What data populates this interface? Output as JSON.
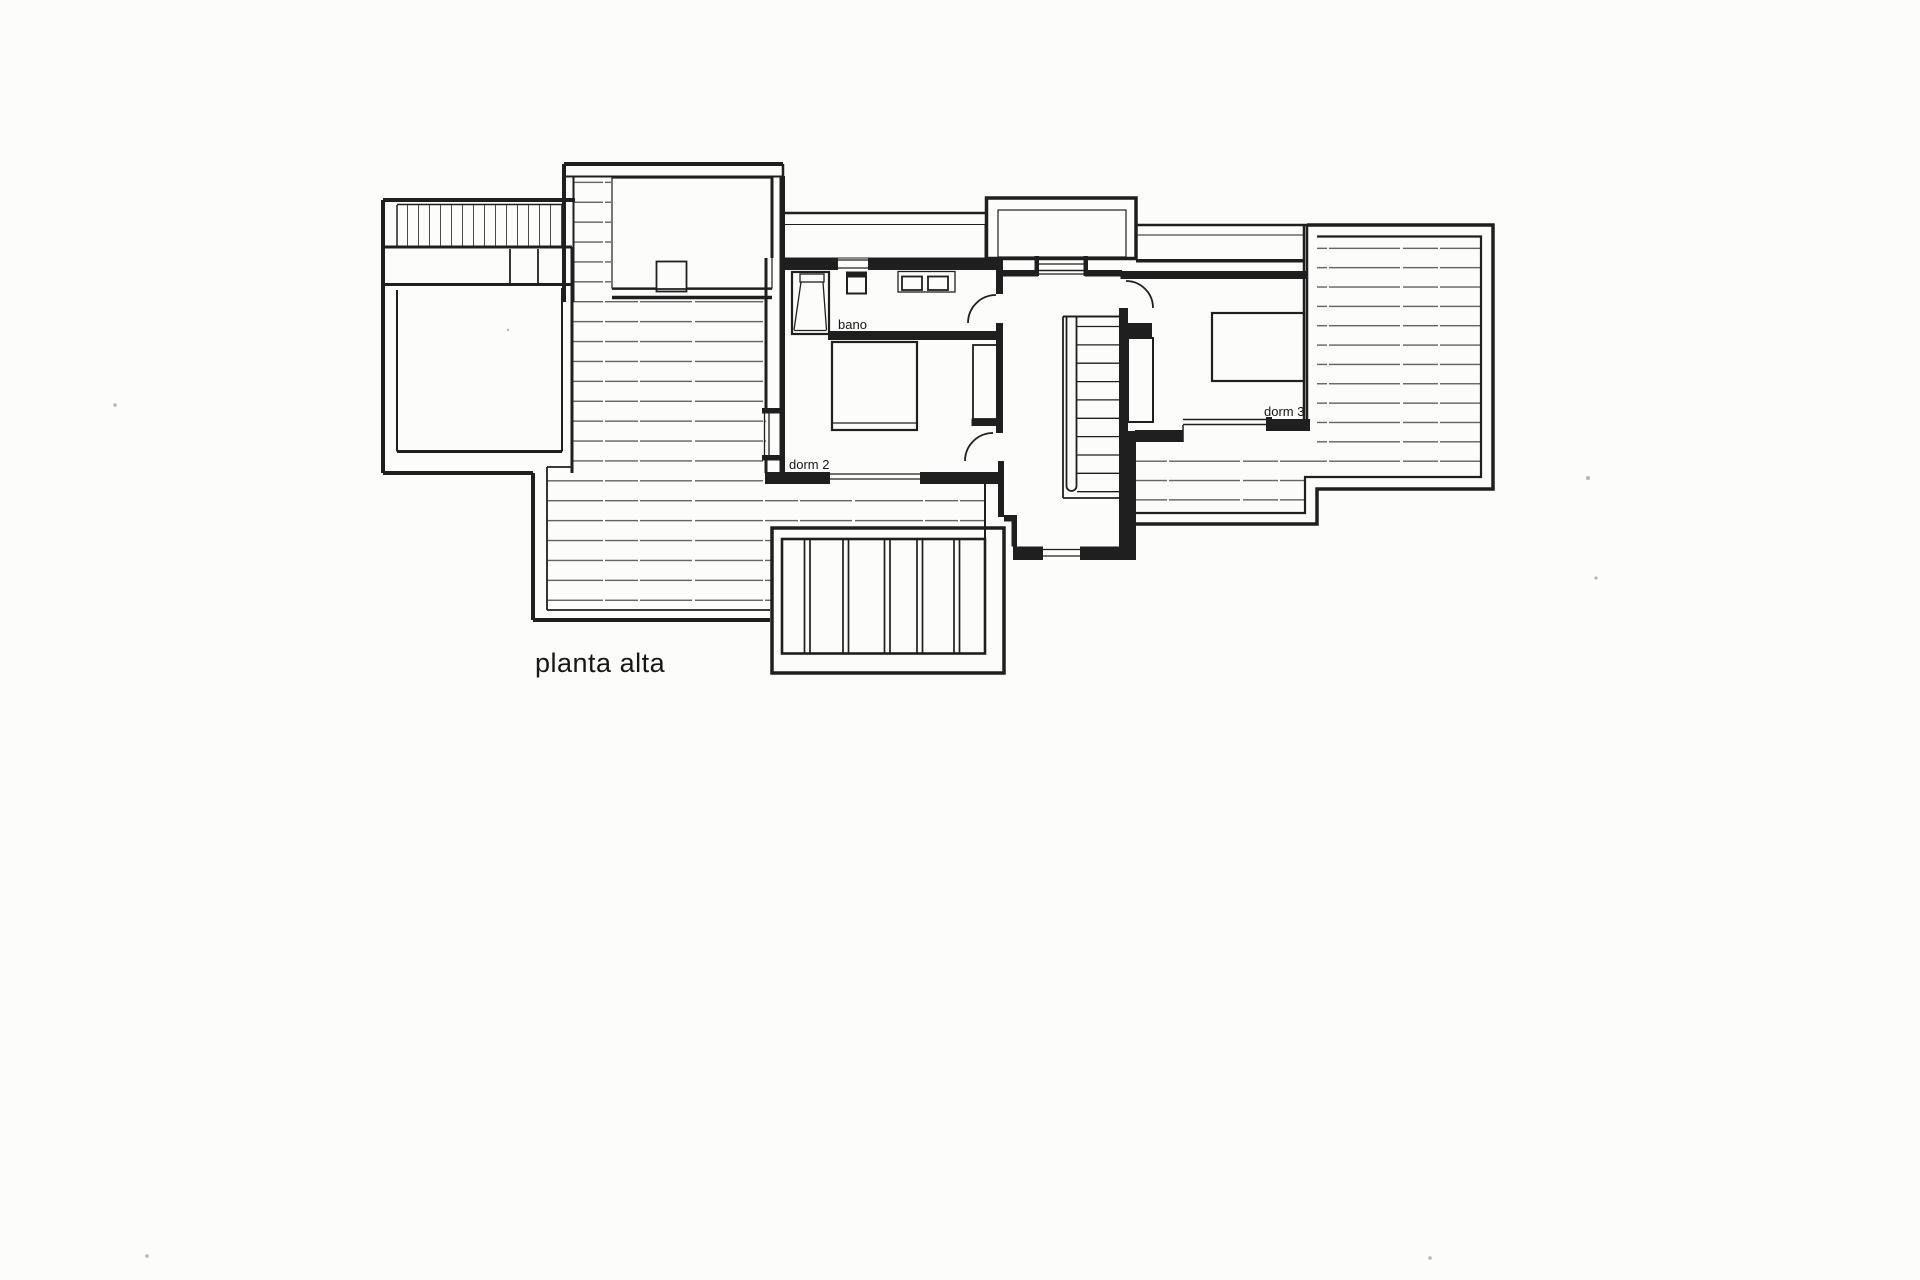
{
  "document": {
    "type": "scanned architectural floor plan",
    "caption": "planta alta"
  },
  "labels": {
    "bathroom": "bano",
    "bedroom2": "dorm 2",
    "bedroom3": "dorm 3",
    "caption": "planta alta"
  },
  "colors": {
    "paper": "#fcfcfa",
    "ink": "#1f1f1f",
    "deck_line": "#4f4f4f",
    "stipple_dot": "#454545"
  },
  "rooms": [
    {
      "name": "bano",
      "kind": "bathroom"
    },
    {
      "name": "dorm 2",
      "kind": "bedroom"
    },
    {
      "name": "dorm 3",
      "kind": "bedroom"
    }
  ]
}
